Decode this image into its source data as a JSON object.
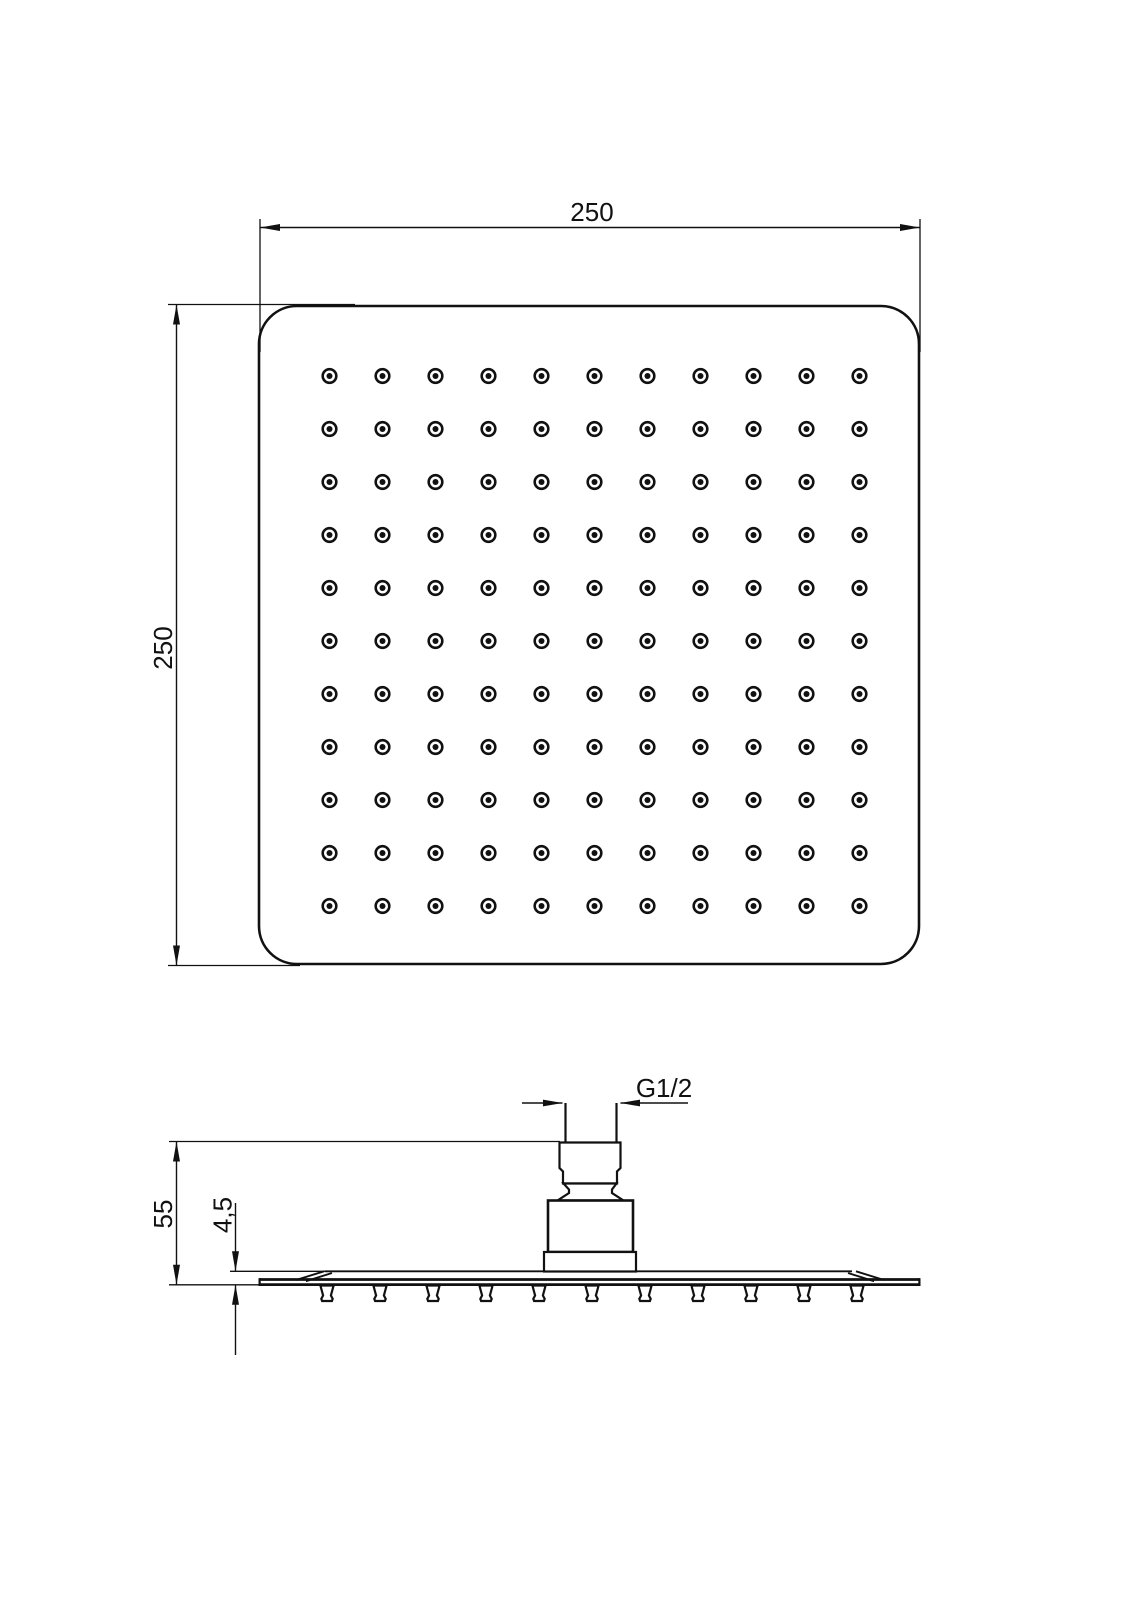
{
  "page": {
    "background": "#ffffff",
    "line_color": "#111111"
  },
  "views": {
    "top": {
      "dims": {
        "width": "250",
        "height": "250"
      },
      "spray_holes": {
        "rows": 11,
        "cols": 11
      }
    },
    "side": {
      "dims": {
        "thread": "G1/2",
        "height": "55",
        "plate_thickness": "4,5"
      },
      "nozzle_count": 11
    }
  }
}
